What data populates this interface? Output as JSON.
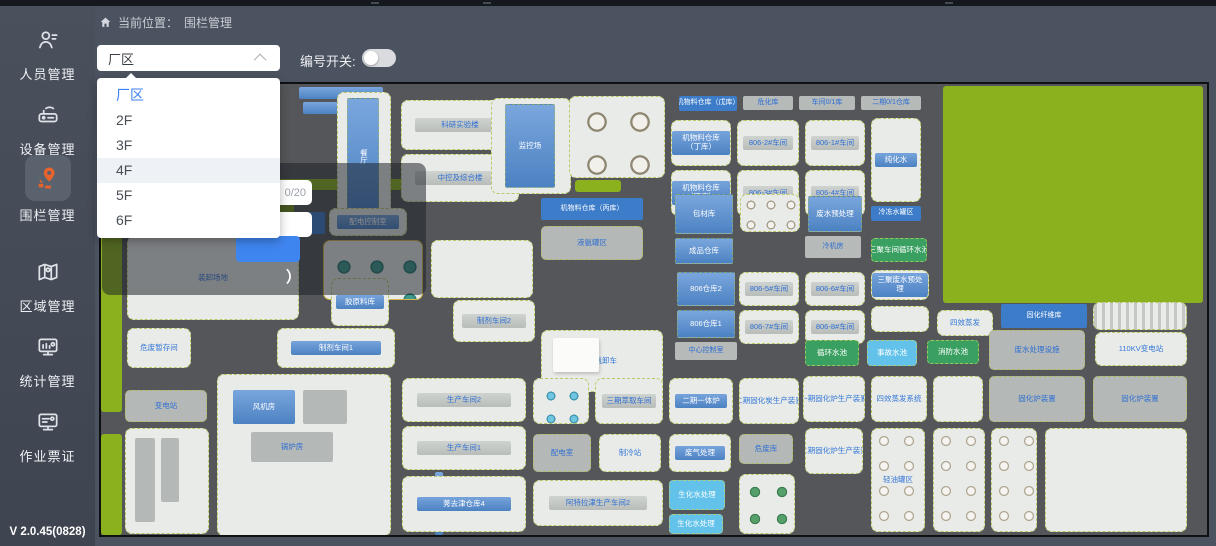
{
  "app": {
    "version": "V 2.0.45(0828)"
  },
  "sidebar": {
    "items": [
      {
        "label": "人员管理",
        "icon": "person-icon",
        "active": false
      },
      {
        "label": "设备管理",
        "icon": "device-icon",
        "active": false
      },
      {
        "label": "围栏管理",
        "icon": "fence-pin-icon",
        "active": true,
        "active_color": "#e8632c"
      },
      {
        "label": "区域管理",
        "icon": "region-map-icon",
        "active": false
      },
      {
        "label": "统计管理",
        "icon": "stats-monitor-icon",
        "active": false
      },
      {
        "label": "作业票证",
        "icon": "work-ticket-icon",
        "active": false
      }
    ]
  },
  "topbar": {
    "breadcrumb_prefix": "当前位置：",
    "breadcrumb_current": "围栏管理"
  },
  "controls": {
    "floor_select": {
      "value": "厂区",
      "options": [
        "厂区",
        "2F",
        "3F",
        "4F",
        "5F",
        "6F"
      ],
      "selected_index": 0,
      "hovered_index": 3,
      "selected_color": "#3b82f6"
    },
    "number_switch_label": "编号开关:",
    "number_switch_on": false
  },
  "popup": {
    "char_count": "0/20",
    "partial_text": "）",
    "button_color": "#3f85f0"
  },
  "map": {
    "colors": {
      "road": "#545659",
      "tile": "#e9ebe8",
      "building_blue": "#4c82c2",
      "label_blue": "#3477d8",
      "grass": "#8cb11f",
      "fence_dash": "#acbc3e"
    },
    "tiles": [
      {
        "x": 0,
        "y": 146,
        "w": 21,
        "h": 182,
        "k": "green"
      },
      {
        "x": 0,
        "y": 350,
        "w": 21,
        "h": 101,
        "k": "green"
      },
      {
        "x": 842,
        "y": 2,
        "w": 260,
        "h": 217,
        "k": "green"
      },
      {
        "x": 29,
        "y": 112,
        "w": 66,
        "h": 20,
        "k": "green"
      },
      {
        "x": 101,
        "y": 112,
        "w": 92,
        "h": 20,
        "k": "greend"
      },
      {
        "x": 152,
        "y": 95,
        "w": 166,
        "h": 11,
        "k": "green"
      },
      {
        "x": 474,
        "y": 96,
        "w": 46,
        "h": 12,
        "k": "green"
      },
      {
        "x": 198,
        "y": 3,
        "w": 84,
        "h": 12,
        "k": "bluebar"
      },
      {
        "x": 202,
        "y": 18,
        "w": 84,
        "h": 12,
        "k": "bluebar"
      },
      {
        "x": 236,
        "y": 8,
        "w": 54,
        "h": 128,
        "k": "tile"
      },
      {
        "x": 246,
        "y": 14,
        "w": 32,
        "h": 116,
        "k": "blue vert",
        "label": "餐厅"
      },
      {
        "x": 300,
        "y": 16,
        "w": 118,
        "h": 50,
        "k": "gtile",
        "label": "科研实验楼"
      },
      {
        "x": 300,
        "y": 70,
        "w": 118,
        "h": 48,
        "k": "gtile",
        "label": "中控及综合楼"
      },
      {
        "x": 390,
        "y": 14,
        "w": 80,
        "h": 96,
        "k": "tile"
      },
      {
        "x": 404,
        "y": 20,
        "w": 50,
        "h": 84,
        "k": "blue",
        "label": "监控场"
      },
      {
        "x": 468,
        "y": 12,
        "w": 96,
        "h": 82,
        "k": "tank4"
      },
      {
        "x": 578,
        "y": 12,
        "w": 58,
        "h": 15,
        "k": "chip",
        "label": "机物料仓库（戊库）"
      },
      {
        "x": 642,
        "y": 12,
        "w": 50,
        "h": 14,
        "k": "graychip",
        "label": "危化库"
      },
      {
        "x": 698,
        "y": 12,
        "w": 56,
        "h": 14,
        "k": "graychip",
        "label": "车间0/1库"
      },
      {
        "x": 760,
        "y": 12,
        "w": 60,
        "h": 14,
        "k": "graychip",
        "label": "二期0/1仓库"
      },
      {
        "x": 570,
        "y": 36,
        "w": 60,
        "h": 46,
        "k": "btile",
        "label": "机物料仓库（丁库）"
      },
      {
        "x": 570,
        "y": 86,
        "w": 60,
        "h": 46,
        "k": "btile",
        "label": "机物料仓库（丁库）"
      },
      {
        "x": 636,
        "y": 36,
        "w": 62,
        "h": 46,
        "k": "gtile",
        "label": "806-2#车间"
      },
      {
        "x": 704,
        "y": 36,
        "w": 60,
        "h": 46,
        "k": "gtile",
        "label": "806-1#车间"
      },
      {
        "x": 636,
        "y": 86,
        "w": 62,
        "h": 46,
        "k": "gtile",
        "label": "806-3#车间"
      },
      {
        "x": 704,
        "y": 86,
        "w": 60,
        "h": 46,
        "k": "gtile",
        "label": "806-4#车间"
      },
      {
        "x": 770,
        "y": 34,
        "w": 50,
        "h": 84,
        "k": "btile",
        "label": "纯化水"
      },
      {
        "x": 770,
        "y": 122,
        "w": 50,
        "h": 15,
        "k": "chip",
        "label": "冷冻水罐区"
      },
      {
        "x": 164,
        "y": 128,
        "w": 60,
        "h": 22,
        "k": "chip",
        "label": "原料库"
      },
      {
        "x": 228,
        "y": 124,
        "w": 78,
        "h": 28,
        "k": "btile",
        "label": "配电控制室"
      },
      {
        "x": 440,
        "y": 114,
        "w": 102,
        "h": 22,
        "k": "chip",
        "label": "机物料仓库（丙库）"
      },
      {
        "x": 440,
        "y": 142,
        "w": 102,
        "h": 34,
        "k": "gray",
        "label": "液氨罐区"
      },
      {
        "x": 574,
        "y": 110,
        "w": 58,
        "h": 40,
        "k": "blue",
        "label": "包材库"
      },
      {
        "x": 574,
        "y": 154,
        "w": 58,
        "h": 26,
        "k": "blue",
        "label": "成品仓库"
      },
      {
        "x": 576,
        "y": 188,
        "w": 58,
        "h": 34,
        "k": "blue",
        "label": "806仓库2"
      },
      {
        "x": 576,
        "y": 226,
        "w": 58,
        "h": 28,
        "k": "blue",
        "label": "806仓库1"
      },
      {
        "x": 574,
        "y": 258,
        "w": 62,
        "h": 18,
        "k": "graychip",
        "label": "中心控制室"
      },
      {
        "x": 639,
        "y": 110,
        "w": 60,
        "h": 38,
        "k": "tank12"
      },
      {
        "x": 707,
        "y": 112,
        "w": 54,
        "h": 36,
        "k": "blue",
        "label": "废水预处理"
      },
      {
        "x": 638,
        "y": 188,
        "w": 60,
        "h": 34,
        "k": "gtile",
        "label": "806-5#车间"
      },
      {
        "x": 704,
        "y": 188,
        "w": 60,
        "h": 34,
        "k": "gtile",
        "label": "806-6#车间"
      },
      {
        "x": 638,
        "y": 226,
        "w": 60,
        "h": 34,
        "k": "gtile",
        "label": "806-7#车间"
      },
      {
        "x": 704,
        "y": 226,
        "w": 60,
        "h": 34,
        "k": "gtile",
        "label": "806-8#车间"
      },
      {
        "x": 704,
        "y": 152,
        "w": 56,
        "h": 22,
        "k": "graychip",
        "label": "冷机房"
      },
      {
        "x": 770,
        "y": 154,
        "w": 56,
        "h": 24,
        "k": "poolg",
        "label": "三聚车间循环水池"
      },
      {
        "x": 770,
        "y": 186,
        "w": 58,
        "h": 30,
        "k": "btile",
        "label": "三聚废水预处理"
      },
      {
        "x": 770,
        "y": 222,
        "w": 58,
        "h": 26,
        "k": "tile"
      },
      {
        "x": 836,
        "y": 226,
        "w": 56,
        "h": 26,
        "k": "tile",
        "label": "四效蒸发"
      },
      {
        "x": 900,
        "y": 220,
        "w": 86,
        "h": 24,
        "k": "chip",
        "label": "固化纤维库"
      },
      {
        "x": 992,
        "y": 218,
        "w": 94,
        "h": 28,
        "k": "stripes"
      },
      {
        "x": 26,
        "y": 152,
        "w": 172,
        "h": 84,
        "k": "tile",
        "label": "装卸场地"
      },
      {
        "x": 222,
        "y": 156,
        "w": 100,
        "h": 60,
        "k": "tank3"
      },
      {
        "x": 330,
        "y": 156,
        "w": 102,
        "h": 58,
        "k": "tile"
      },
      {
        "x": 26,
        "y": 244,
        "w": 64,
        "h": 40,
        "k": "tile",
        "label": "危废暂存间"
      },
      {
        "x": 230,
        "y": 194,
        "w": 58,
        "h": 48,
        "k": "btile",
        "label": "胶原料库"
      },
      {
        "x": 352,
        "y": 216,
        "w": 82,
        "h": 42,
        "k": "gtile",
        "label": "制剂车间2"
      },
      {
        "x": 176,
        "y": 244,
        "w": 118,
        "h": 40,
        "k": "btile",
        "label": "制剂车间1"
      },
      {
        "x": 440,
        "y": 246,
        "w": 122,
        "h": 62,
        "k": "tile",
        "label": "液氨卸车"
      },
      {
        "x": 452,
        "y": 254,
        "w": 46,
        "h": 34,
        "k": "wb"
      },
      {
        "x": 24,
        "y": 306,
        "w": 82,
        "h": 32,
        "k": "gray",
        "label": "变电站"
      },
      {
        "x": 24,
        "y": 344,
        "w": 84,
        "h": 106,
        "k": "tile"
      },
      {
        "x": 34,
        "y": 354,
        "w": 20,
        "h": 84,
        "k": "gb"
      },
      {
        "x": 60,
        "y": 354,
        "w": 18,
        "h": 64,
        "k": "gb"
      },
      {
        "x": 116,
        "y": 290,
        "w": 174,
        "h": 162,
        "k": "tile"
      },
      {
        "x": 132,
        "y": 306,
        "w": 62,
        "h": 34,
        "k": "bb",
        "label": "风机房"
      },
      {
        "x": 202,
        "y": 306,
        "w": 44,
        "h": 34,
        "k": "gb"
      },
      {
        "x": 150,
        "y": 348,
        "w": 82,
        "h": 30,
        "k": "gb",
        "label": "锅炉房"
      },
      {
        "x": 334,
        "y": 388,
        "w": 8,
        "h": 63,
        "k": "bb"
      },
      {
        "x": 301,
        "y": 294,
        "w": 124,
        "h": 44,
        "k": "gtile",
        "label": "生产车间2"
      },
      {
        "x": 301,
        "y": 342,
        "w": 124,
        "h": 44,
        "k": "gtile",
        "label": "生产车间1"
      },
      {
        "x": 301,
        "y": 392,
        "w": 124,
        "h": 56,
        "k": "btile",
        "label": "莠去津仓库4"
      },
      {
        "x": 432,
        "y": 294,
        "w": 56,
        "h": 46,
        "k": "ttile"
      },
      {
        "x": 494,
        "y": 294,
        "w": 68,
        "h": 46,
        "k": "gtile",
        "label": "三期萃取车间"
      },
      {
        "x": 432,
        "y": 350,
        "w": 58,
        "h": 38,
        "k": "gray",
        "label": "配电室"
      },
      {
        "x": 498,
        "y": 350,
        "w": 62,
        "h": 38,
        "k": "tile",
        "label": "制冷站"
      },
      {
        "x": 432,
        "y": 396,
        "w": 130,
        "h": 46,
        "k": "gtile",
        "label": "阿特拉津生产车间2"
      },
      {
        "x": 568,
        "y": 294,
        "w": 64,
        "h": 46,
        "k": "btile",
        "label": "二期一体炉"
      },
      {
        "x": 568,
        "y": 350,
        "w": 62,
        "h": 38,
        "k": "btile",
        "label": "废气处理"
      },
      {
        "x": 568,
        "y": 396,
        "w": 56,
        "h": 30,
        "k": "poolc",
        "label": "生化水处理"
      },
      {
        "x": 568,
        "y": 430,
        "w": 54,
        "h": 20,
        "k": "poolc",
        "label": "生化水处理"
      },
      {
        "x": 638,
        "y": 294,
        "w": 60,
        "h": 46,
        "k": "tile",
        "label": "二期固化炭生产装置"
      },
      {
        "x": 638,
        "y": 350,
        "w": 54,
        "h": 30,
        "k": "gray",
        "label": "危废库"
      },
      {
        "x": 638,
        "y": 390,
        "w": 56,
        "h": 60,
        "k": "tank6"
      },
      {
        "x": 704,
        "y": 256,
        "w": 54,
        "h": 26,
        "k": "poolg",
        "label": "循环水池"
      },
      {
        "x": 766,
        "y": 256,
        "w": 50,
        "h": 26,
        "k": "poolc",
        "label": "事故水池"
      },
      {
        "x": 826,
        "y": 256,
        "w": 52,
        "h": 24,
        "k": "poolg",
        "label": "消防水池"
      },
      {
        "x": 888,
        "y": 246,
        "w": 96,
        "h": 40,
        "k": "gray",
        "label": "废水处理设施"
      },
      {
        "x": 994,
        "y": 248,
        "w": 92,
        "h": 34,
        "k": "tile",
        "label": "110KV变电站"
      },
      {
        "x": 702,
        "y": 292,
        "w": 62,
        "h": 46,
        "k": "tile",
        "label": "一期固化炉生产装置"
      },
      {
        "x": 770,
        "y": 292,
        "w": 56,
        "h": 46,
        "k": "tile",
        "label": "四效蒸发系统"
      },
      {
        "x": 832,
        "y": 292,
        "w": 50,
        "h": 46,
        "k": "tile"
      },
      {
        "x": 888,
        "y": 292,
        "w": 96,
        "h": 46,
        "k": "gray",
        "label": "固化炉装置"
      },
      {
        "x": 992,
        "y": 292,
        "w": 94,
        "h": 46,
        "k": "gray",
        "label": "固化炉装置"
      },
      {
        "x": 704,
        "y": 344,
        "w": 58,
        "h": 46,
        "k": "tile",
        "label": "二期固化炉生产装置"
      },
      {
        "x": 770,
        "y": 344,
        "w": 54,
        "h": 104,
        "k": "tankv",
        "label": "轻油罐区"
      },
      {
        "x": 832,
        "y": 344,
        "w": 52,
        "h": 104,
        "k": "tankv"
      },
      {
        "x": 890,
        "y": 344,
        "w": 46,
        "h": 104,
        "k": "tankv"
      },
      {
        "x": 944,
        "y": 344,
        "w": 142,
        "h": 104,
        "k": "tile"
      }
    ]
  }
}
